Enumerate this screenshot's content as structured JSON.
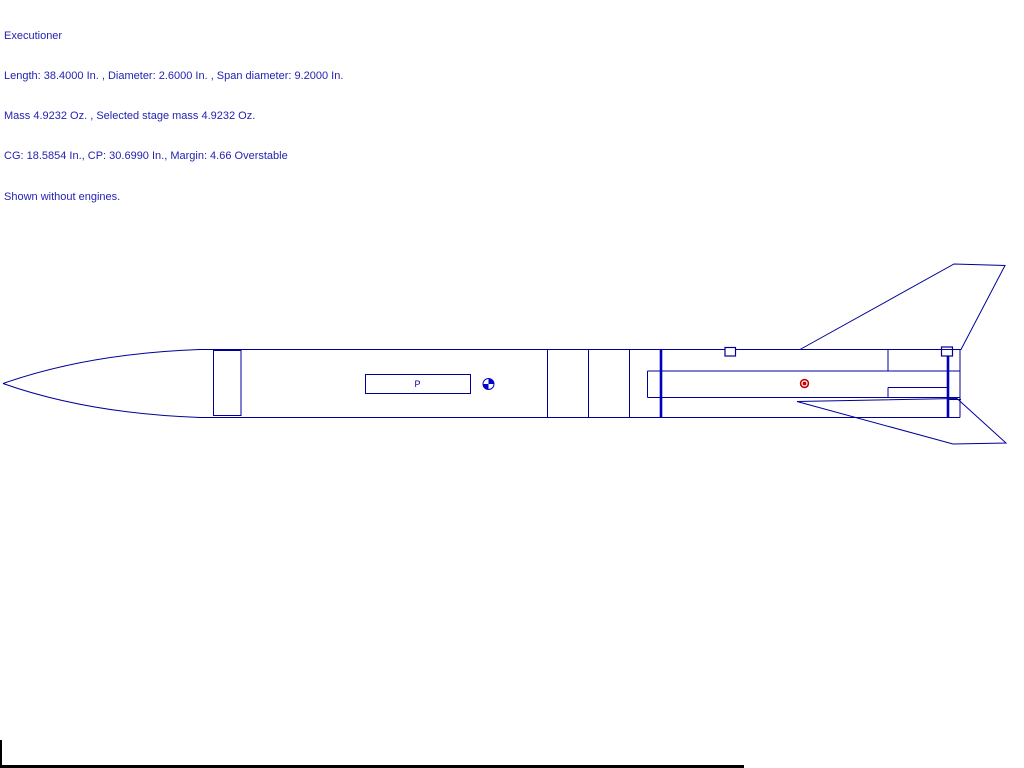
{
  "header": {
    "title": "Executioner",
    "dimensions_line": "Length: 38.4000 In. , Diameter: 2.6000 In. , Span diameter: 9.2000 In.",
    "mass_line": "Mass 4.9232 Oz. , Selected stage mass 4.9232 Oz.",
    "stability_line": "CG: 18.5854 In., CP: 30.6990 In., Margin: 4.66 Overstable",
    "note_line": "Shown without engines."
  },
  "rocket": {
    "name": "Executioner",
    "length_in": "38.4000",
    "diameter_in": "2.6000",
    "span_diameter_in": "9.2000",
    "mass_oz": "4.9232",
    "selected_stage_mass_oz": "4.9232",
    "cg_in": "18.5854",
    "cp_in": "30.6990",
    "margin": "4.66",
    "stability": "Overstable",
    "engines_note": "Shown without engines.",
    "parachute_label": "P"
  },
  "diagram": {
    "markers": [
      {
        "label": "center-of-gravity",
        "style": "quartered-circle"
      },
      {
        "label": "center-of-pressure",
        "style": "red-ring-dot"
      }
    ]
  },
  "colors": {
    "line": "#000099",
    "thick-line": "#0000bb",
    "text": "#2323b3",
    "cg": "#0000cc",
    "cp": "#cc0000",
    "background": "#ffffff",
    "edge": "#000000"
  }
}
